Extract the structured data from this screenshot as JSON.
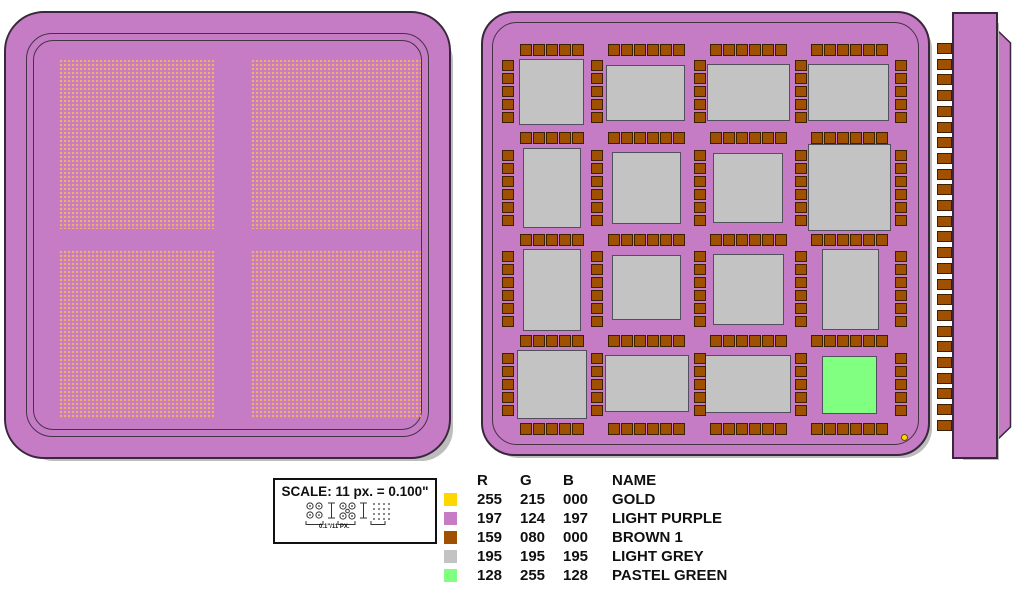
{
  "scale_box": {
    "title": "SCALE: 11 px. = 0.100\"",
    "caption": "0.1\"/11 PX.",
    "geometry": {
      "x": 273,
      "y": 478,
      "w": 164,
      "h": 66
    }
  },
  "legend": {
    "geometry": {
      "x": 444,
      "y": 471
    },
    "headers": [
      "R",
      "G",
      "B",
      "NAME"
    ],
    "rows": [
      {
        "r": "255",
        "g": "215",
        "b": "000",
        "name": "GOLD",
        "hex": "#FFD700"
      },
      {
        "r": "197",
        "g": "124",
        "b": "197",
        "name": "LIGHT PURPLE",
        "hex": "#C57CC5"
      },
      {
        "r": "159",
        "g": "080",
        "b": "000",
        "name": "BROWN 1",
        "hex": "#9F5000"
      },
      {
        "r": "195",
        "g": "195",
        "b": "195",
        "name": "LIGHT GREY",
        "hex": "#C3C3C3"
      },
      {
        "r": "128",
        "g": "255",
        "b": "128",
        "name": "PASTEL GREEN",
        "hex": "#80FF80"
      }
    ]
  },
  "colors": {
    "gold": "#FFD700",
    "light_purple": "#C57CC5",
    "brown": "#9F5000",
    "light_grey": "#C3C3C3",
    "pastel_green": "#80FF80",
    "outline_dark": "#39283B",
    "pad_outline": "#3A2000",
    "module_outline": "#50505C",
    "shadow_grey": "#BDBDBD",
    "dot_color": "#F3AE63"
  },
  "top_view": {
    "geometry": {
      "x": 4,
      "y": 11,
      "w": 447,
      "h": 448,
      "radius": 40
    },
    "rings": [
      {
        "inset": 20,
        "radius": 26
      },
      {
        "inset": 27,
        "radius": 20
      }
    ],
    "quadrants": [
      {
        "x": 53,
        "y": 46,
        "w": 156,
        "h": 170
      },
      {
        "x": 245,
        "y": 46,
        "w": 170,
        "h": 170
      },
      {
        "x": 53,
        "y": 237,
        "w": 156,
        "h": 169
      },
      {
        "x": 245,
        "y": 237,
        "w": 170,
        "h": 169
      }
    ],
    "dot_pitch_px": 4
  },
  "bottom_view": {
    "geometry": {
      "x": 481,
      "y": 11,
      "w": 449,
      "h": 445,
      "radius": 33
    },
    "ring": {
      "inset": 9,
      "radius": 25
    },
    "modules": [
      {
        "row": 1,
        "col": 1,
        "x": 36,
        "y": 46,
        "w": 65,
        "h": 66,
        "color": "light_grey"
      },
      {
        "row": 1,
        "col": 2,
        "x": 123,
        "y": 52,
        "w": 79,
        "h": 56,
        "color": "light_grey"
      },
      {
        "row": 1,
        "col": 3,
        "x": 224,
        "y": 51,
        "w": 83,
        "h": 57,
        "color": "light_grey"
      },
      {
        "row": 1,
        "col": 4,
        "x": 325,
        "y": 51,
        "w": 81,
        "h": 57,
        "color": "light_grey"
      },
      {
        "row": 2,
        "col": 1,
        "x": 40,
        "y": 135,
        "w": 58,
        "h": 80,
        "color": "light_grey"
      },
      {
        "row": 2,
        "col": 2,
        "x": 129,
        "y": 139,
        "w": 69,
        "h": 72,
        "color": "light_grey"
      },
      {
        "row": 2,
        "col": 3,
        "x": 230,
        "y": 140,
        "w": 70,
        "h": 70,
        "color": "light_grey"
      },
      {
        "row": 2,
        "col": 4,
        "x": 325,
        "y": 131,
        "w": 83,
        "h": 87,
        "color": "light_grey"
      },
      {
        "row": 3,
        "col": 1,
        "x": 40,
        "y": 236,
        "w": 58,
        "h": 82,
        "color": "light_grey"
      },
      {
        "row": 3,
        "col": 2,
        "x": 129,
        "y": 242,
        "w": 69,
        "h": 65,
        "color": "light_grey"
      },
      {
        "row": 3,
        "col": 3,
        "x": 230,
        "y": 241,
        "w": 71,
        "h": 71,
        "color": "light_grey"
      },
      {
        "row": 3,
        "col": 4,
        "x": 339,
        "y": 236,
        "w": 57,
        "h": 81,
        "color": "light_grey"
      },
      {
        "row": 4,
        "col": 1,
        "x": 34,
        "y": 337,
        "w": 70,
        "h": 69,
        "color": "light_grey"
      },
      {
        "row": 4,
        "col": 2,
        "x": 122,
        "y": 342,
        "w": 84,
        "h": 57,
        "color": "light_grey"
      },
      {
        "row": 4,
        "col": 3,
        "x": 222,
        "y": 342,
        "w": 86,
        "h": 58,
        "color": "light_grey"
      },
      {
        "row": 4,
        "col": 4,
        "x": 339,
        "y": 343,
        "w": 55,
        "h": 58,
        "color": "pastel_green"
      }
    ],
    "pad_size": 12,
    "pad_pitch": 13,
    "pad_rows_y": [
      31,
      119,
      221,
      322,
      410
    ],
    "col_centers": [
      69,
      163,
      265,
      366
    ],
    "col_pad_counts": [
      5,
      6,
      6,
      6
    ],
    "pad_cols_x": [
      19,
      108,
      211,
      312,
      412
    ],
    "row_centers": [
      79,
      175,
      276,
      372
    ],
    "row_pad_counts": [
      5,
      6,
      6,
      5
    ],
    "gold_dot": {
      "x": 418,
      "y": 421,
      "d": 7
    }
  },
  "side_view": {
    "geometry": {
      "x": 930,
      "y": 0,
      "w": 90,
      "h": 475
    },
    "bar": {
      "x": 22,
      "y": 12,
      "w": 46,
      "h": 447
    },
    "fin": {
      "x": 66,
      "y": 28,
      "w": 16,
      "h": 414,
      "points": "1,2 14.5,15 14.5,399 1,412"
    },
    "pads": {
      "x": 7,
      "w": 15,
      "h": 11,
      "start_y": 43,
      "pitch": 15.7,
      "count": 25
    }
  }
}
